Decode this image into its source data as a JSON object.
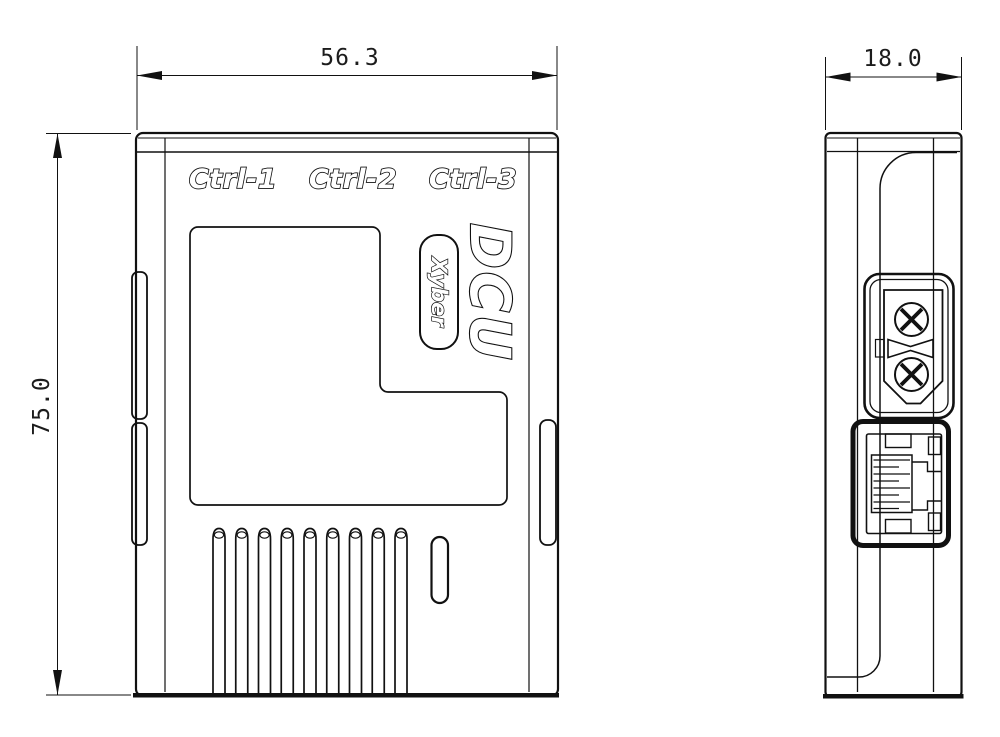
{
  "page": {
    "background": "#ffffff",
    "line_color": "#111111"
  },
  "dimensions": {
    "width_mm": "56.3",
    "height_mm": "75.0",
    "depth_mm": "18.0"
  },
  "front_view": {
    "port_labels": [
      {
        "label": "Ctrl-1"
      },
      {
        "label": "Ctrl-2"
      },
      {
        "label": "Ctrl-3"
      }
    ],
    "product_name": "DCU",
    "brand_badge": "Xyber",
    "vent_slot_count": 9
  },
  "side_view": {
    "features": [
      "xt30-power-connector",
      "rj45-ethernet-port"
    ]
  }
}
